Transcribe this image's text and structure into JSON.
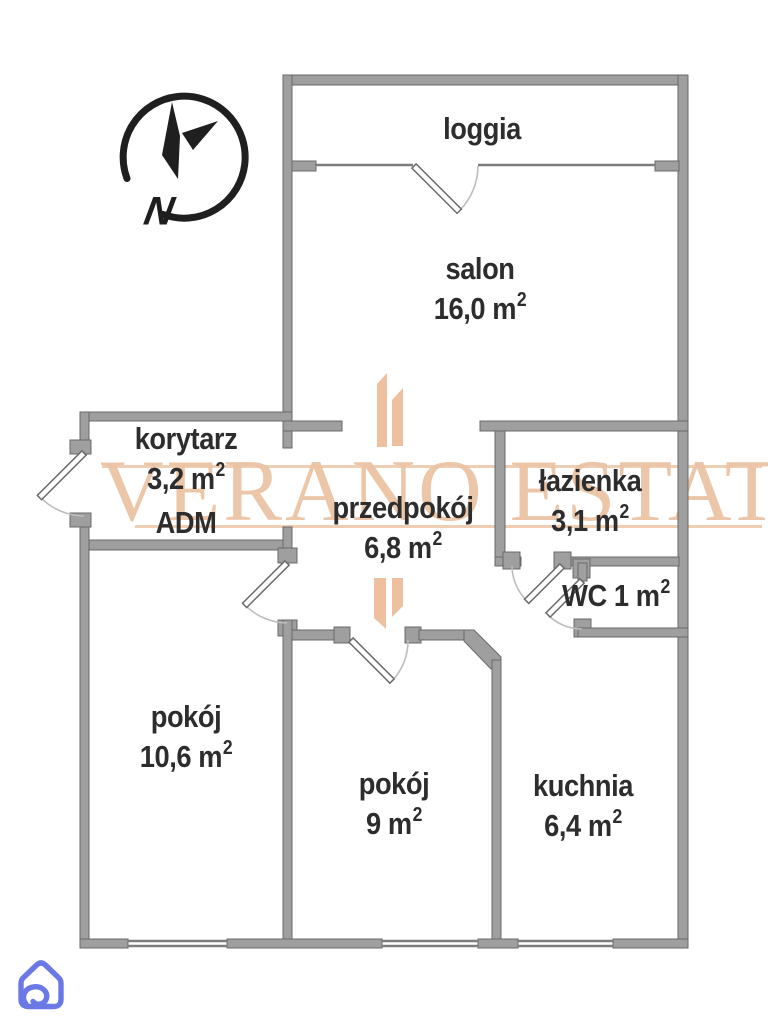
{
  "meta": {
    "sup_two": "2",
    "colors": {
      "wall_fill": "#9f9f9f",
      "wall_edge": "#6a6a6a",
      "label_text": "#2d2d2d",
      "watermark_peach": "#ecc3a4",
      "brand_blue": "#6b79e6"
    }
  },
  "compass": {
    "label": "N"
  },
  "watermark": {
    "text": "VERANO ESTATE"
  },
  "rooms": {
    "loggia": {
      "name": "loggia"
    },
    "salon": {
      "name": "salon",
      "area": "16,0 m"
    },
    "korytarz": {
      "name": "korytarz",
      "area": "3,2 m",
      "note": "ADM"
    },
    "przedpokoj": {
      "name": "przedpokój",
      "area": "6,8 m"
    },
    "lazienka": {
      "name": "łazienka",
      "area": "3,1 m"
    },
    "wc": {
      "name": "WC 1 m"
    },
    "pokoj_a": {
      "name": "pokój",
      "area": "10,6 m"
    },
    "pokoj_b": {
      "name": "pokój",
      "area": "9 m"
    },
    "kuchnia": {
      "name": "kuchnia",
      "area": "6,4 m"
    }
  }
}
